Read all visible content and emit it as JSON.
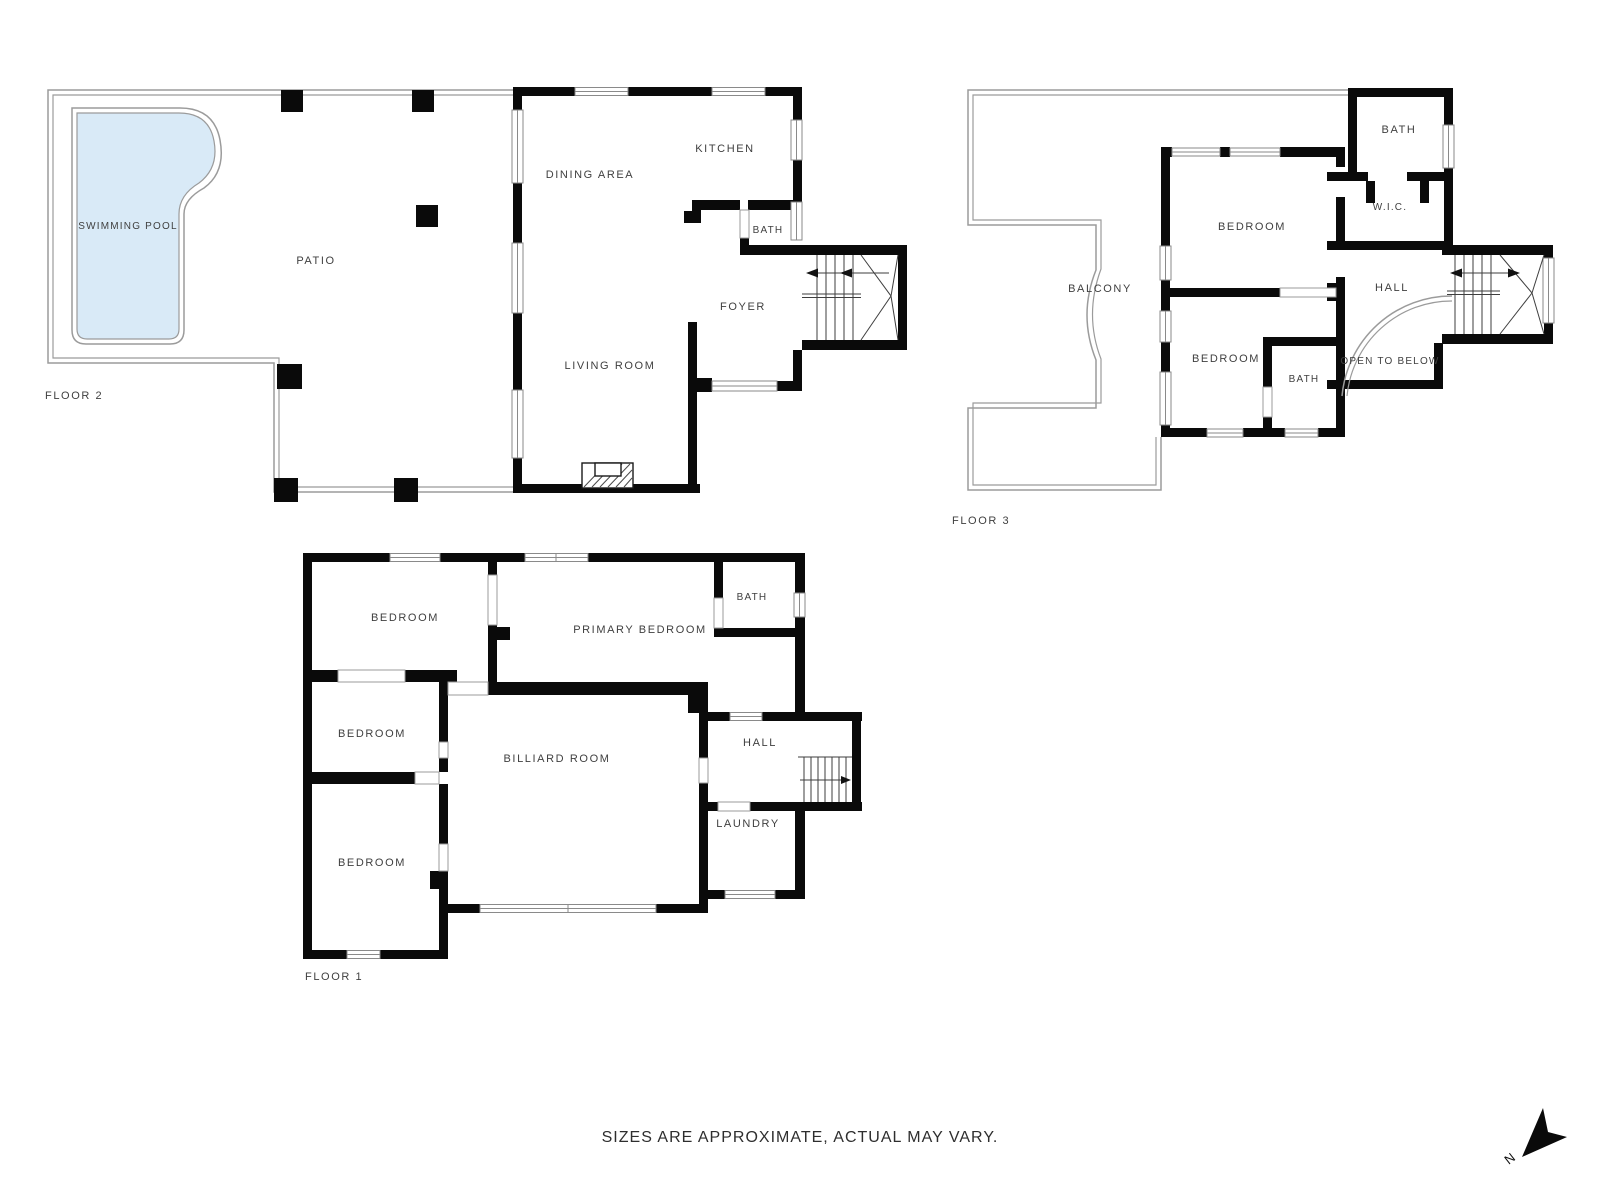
{
  "floors": {
    "floor2": {
      "label": "FLOOR 2",
      "rooms": {
        "swimming_pool": "SWIMMING POOL",
        "patio": "PATIO",
        "dining_area": "DINING AREA",
        "kitchen": "KITCHEN",
        "bath": "BATH",
        "foyer": "FOYER",
        "living_room": "LIVING ROOM"
      }
    },
    "floor3": {
      "label": "FLOOR 3",
      "rooms": {
        "bath_upper": "BATH",
        "wic": "W.I.C.",
        "bedroom_upper": "BEDROOM",
        "balcony": "BALCONY",
        "hall": "HALL",
        "bedroom_lower": "BEDROOM",
        "bath_lower": "BATH",
        "open_to_below": "OPEN TO BELOW"
      }
    },
    "floor1": {
      "label": "FLOOR 1",
      "rooms": {
        "bedroom_top": "BEDROOM",
        "primary_bedroom": "PRIMARY BEDROOM",
        "bath": "BATH",
        "bedroom_middle": "BEDROOM",
        "billiard_room": "BILLIARD ROOM",
        "hall": "HALL",
        "bedroom_bottom": "BEDROOM",
        "laundry": "LAUNDRY"
      }
    }
  },
  "footer": {
    "disclaimer": "SIZES ARE APPROXIMATE, ACTUAL MAY VARY."
  },
  "compass": {
    "north_label": "N"
  },
  "colors": {
    "pool_fill": "#d9eaf7",
    "wall": "#0a0a0a",
    "thin_outline": "#9b9b9b",
    "label_text": "#3f3f3f"
  }
}
